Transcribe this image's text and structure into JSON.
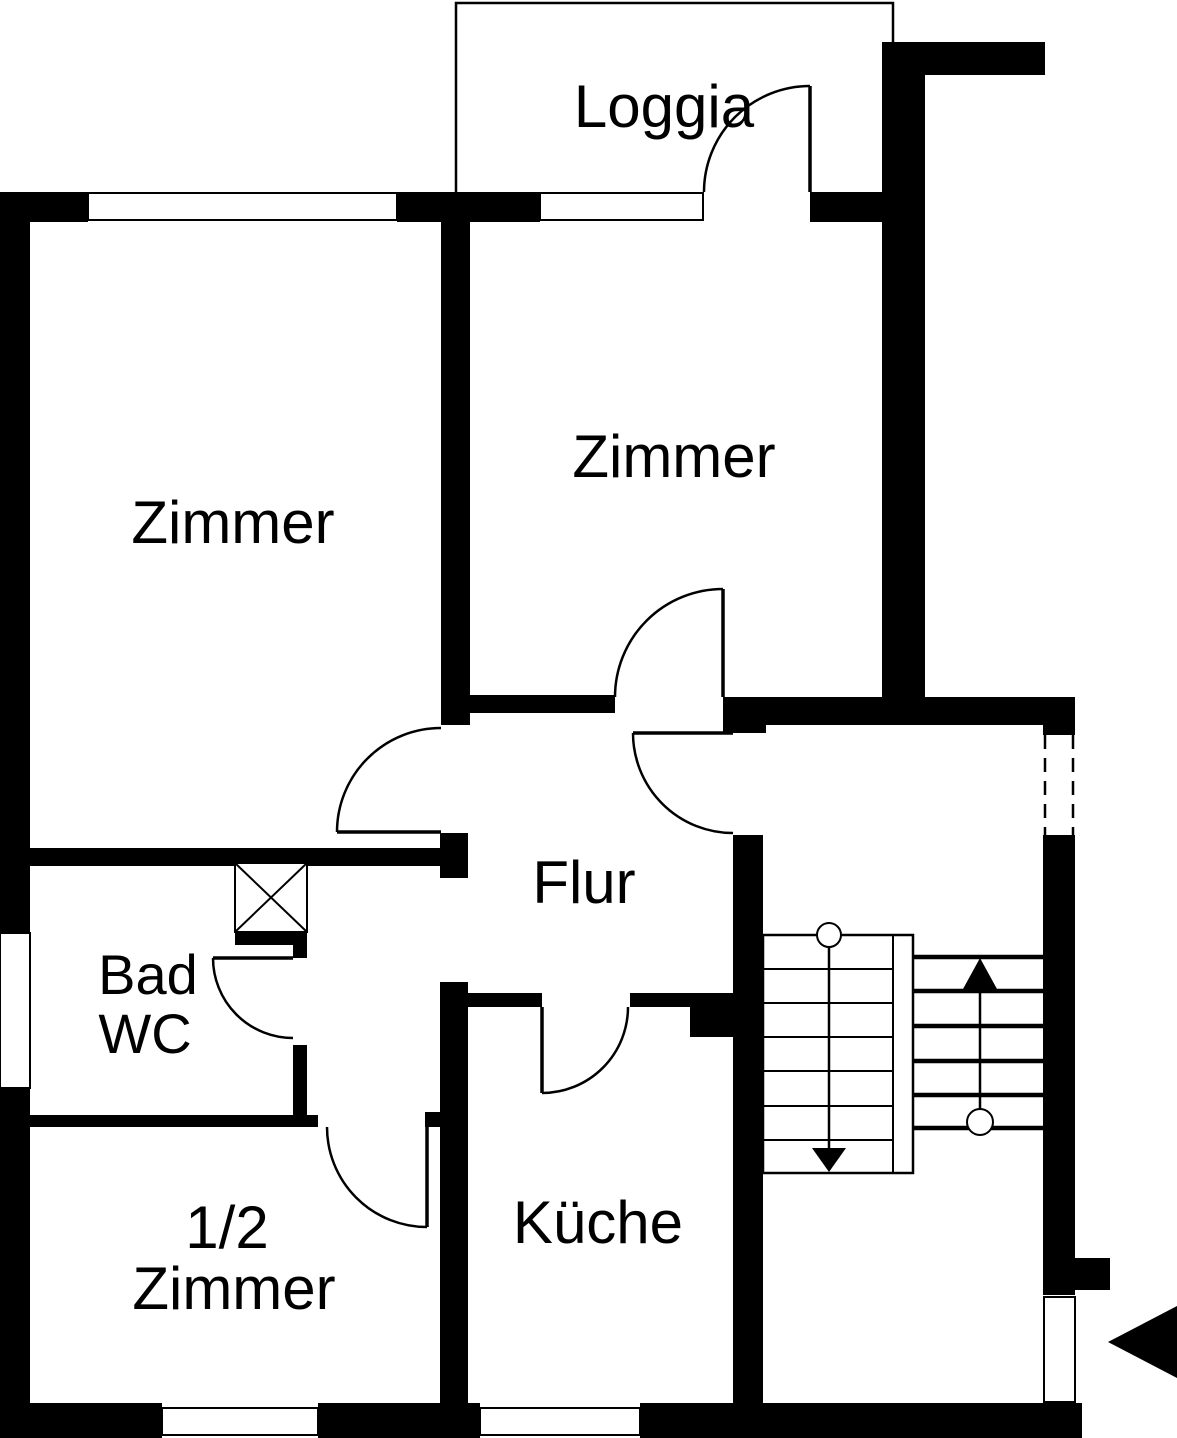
{
  "colors": {
    "ink": "#000000",
    "paper": "#ffffff"
  },
  "rooms": {
    "loggia": {
      "label": "Loggia"
    },
    "zimmer_left": {
      "label": "Zimmer"
    },
    "zimmer_mid": {
      "label": "Zimmer"
    },
    "flur": {
      "label": "Flur"
    },
    "bad_wc": {
      "line1": "Bad",
      "line2": "WC"
    },
    "half_zimmer": {
      "line1": "1/2",
      "line2": "Zimmer"
    },
    "kueche": {
      "label": "Küche"
    }
  },
  "symbols": {
    "stairs_down": "stairs-down-arrow",
    "stairs_up": "stairs-up-arrow",
    "entrance": "entrance-arrow",
    "shaft": "shaft-cross-box",
    "doors": "door-swing-arc",
    "windows": "window-opening",
    "dashed_opening": "dashed-stairwell-window"
  }
}
